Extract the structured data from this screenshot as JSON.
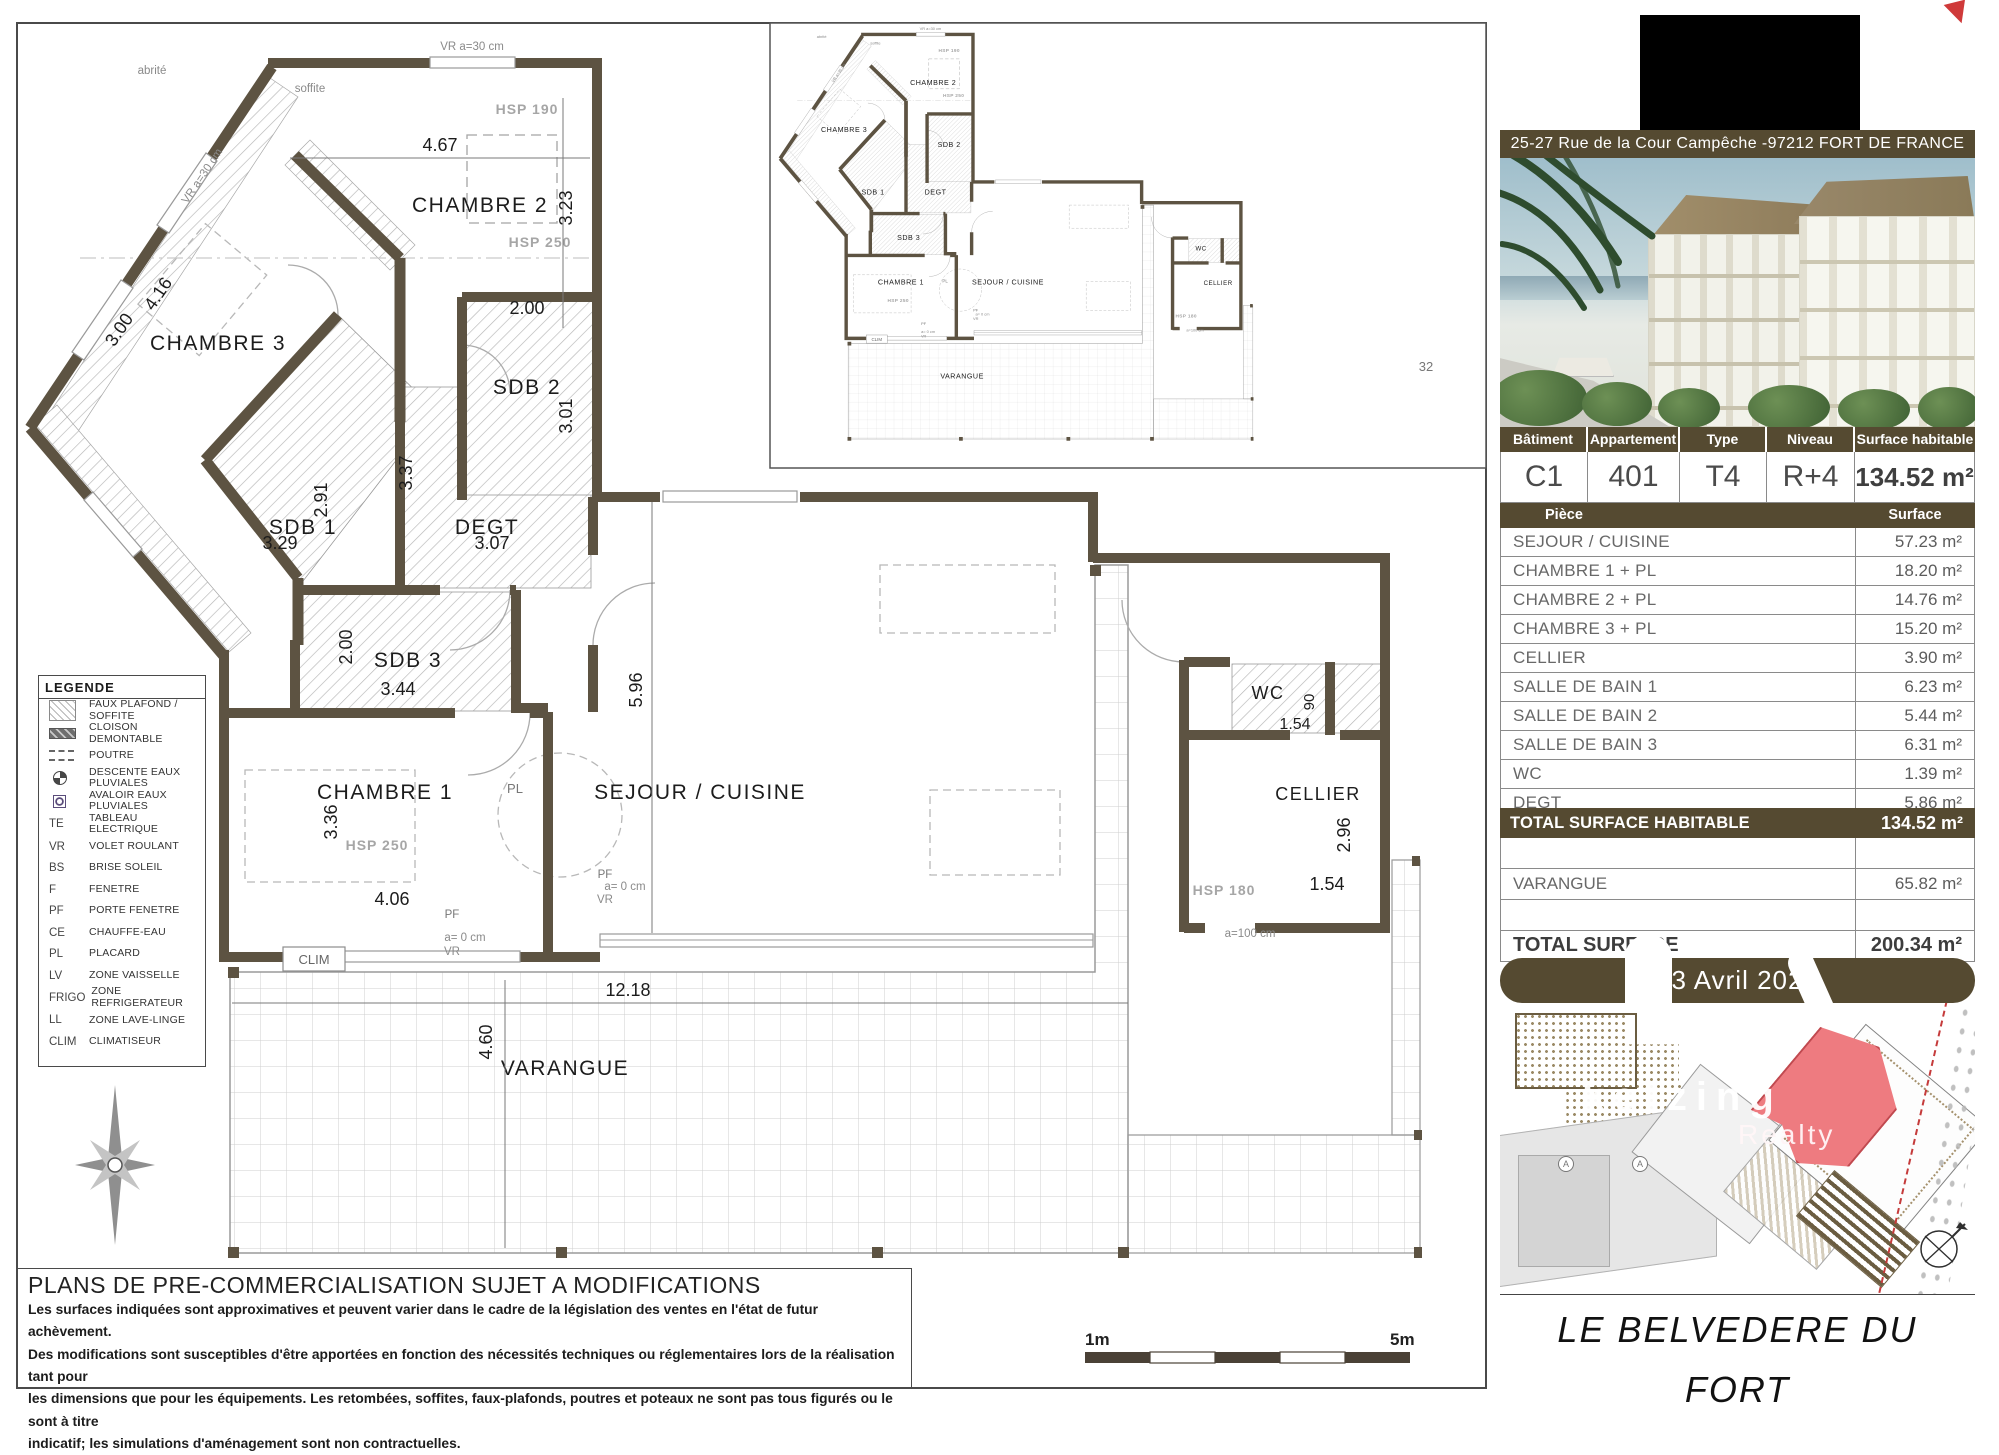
{
  "sheet": {
    "disclaimer_title": "PLANS DE PRE-COMMERCIALISATION SUJET A MODIFICATIONS",
    "disclaimer_lines": [
      "Les surfaces indiquées sont approximatives et peuvent varier dans le cadre de la législation des ventes en l'état de futur achèvement.",
      "Des modifications sont susceptibles d'être apportées en fonction des nécessités techniques ou réglementaires lors de la réalisation tant pour",
      "les dimensions que pour les équipements. Les retombées, soffites, faux-plafonds, poutres et poteaux ne sont pas tous figurés ou le sont à titre",
      "indicatif; les simulations d'aménagement sont non contractuelles."
    ],
    "scale_left": "1m",
    "scale_right": "5m",
    "grid_number": "32"
  },
  "legend": {
    "title": "LEGENDE",
    "items": [
      {
        "icon": "hatch",
        "label": "FAUX PLAFOND / SOFFITE"
      },
      {
        "icon": "cloison",
        "label": "CLOISON DEMONTABLE"
      },
      {
        "icon": "poutre",
        "label": "POUTRE"
      },
      {
        "icon": "dep",
        "label": "DESCENTE EAUX PLUVIALES"
      },
      {
        "icon": "aep",
        "label": "AVALOIR EAUX PLUVIALES"
      },
      {
        "abbr": "TE",
        "label": "TABLEAU ELECTRIQUE"
      },
      {
        "abbr": "VR",
        "label": "VOLET ROULANT"
      },
      {
        "abbr": "BS",
        "label": "BRISE SOLEIL"
      },
      {
        "abbr": "F",
        "label": "FENETRE"
      },
      {
        "abbr": "PF",
        "label": "PORTE FENETRE"
      },
      {
        "abbr": "CE",
        "label": "CHAUFFE-EAU"
      },
      {
        "abbr": "PL",
        "label": "PLACARD"
      },
      {
        "abbr": "LV",
        "label": "ZONE VAISSELLE"
      },
      {
        "abbr": "FRIGO",
        "label": "ZONE REFRIGERATEUR"
      },
      {
        "abbr": "LL",
        "label": "ZONE LAVE-LINGE"
      },
      {
        "abbr": "CLIM",
        "label": "CLIMATISEUR"
      }
    ]
  },
  "plan": {
    "rooms": {
      "chambre2": "CHAMBRE 2",
      "chambre3": "CHAMBRE 3",
      "sdb2": "SDB 2",
      "sdb1": "SDB 1",
      "degt": "DEGT",
      "sdb3": "SDB 3",
      "chambre1": "CHAMBRE 1",
      "sejour": "SEJOUR / CUISINE",
      "wc": "WC",
      "cellier": "CELLIER",
      "varangue": "VARANGUE"
    },
    "dims": {
      "d467": "4.67",
      "d323": "3.23",
      "d416": "4.16",
      "d300": "3.00",
      "d200a": "2.00",
      "d301": "3.01",
      "d291": "2.91",
      "d329": "3.29",
      "d337": "3.37",
      "d307": "3.07",
      "d200b": "2.00",
      "d344": "3.44",
      "d336": "3.36",
      "d406": "4.06",
      "d596": "5.96",
      "d90": "90",
      "d154a": "1.54",
      "d296": "2.96",
      "d154b": "1.54",
      "d1218": "12.18",
      "d460": "4.60"
    },
    "annot": {
      "hsp190": "HSP 190",
      "hsp250a": "HSP 250",
      "hsp250b": "HSP 250",
      "hsp180": "HSP 180",
      "soffite": "soffite",
      "abrite": "abrité",
      "vr30a": "VR a=30 cm",
      "vr30b": "VR a=30 cm",
      "pf1": "PF",
      "a01": "a= 0 cm",
      "vr1": "VR",
      "pf2": "PF",
      "a02": "a= 0 cm",
      "vr2": "VR",
      "a100": "a=100 cm",
      "clim": "CLIM",
      "pl": "PL"
    }
  },
  "sidebar": {
    "address": "25-27 Rue de la Cour Campêche -97212 FORT DE FRANCE",
    "info": {
      "headers": [
        "Bâtiment",
        "Appartement",
        "Type",
        "Niveau",
        "Surface habitable"
      ],
      "values": [
        "C1",
        "401",
        "T4",
        "R+4",
        "134.52 m²"
      ]
    },
    "table": {
      "col_piece": "Pièce",
      "col_surface": "Surface",
      "rows": [
        {
          "name": "SEJOUR / CUISINE",
          "value": "57.23 m²"
        },
        {
          "name": "CHAMBRE 1 + PL",
          "value": "18.20 m²"
        },
        {
          "name": "CHAMBRE 2 + PL",
          "value": "14.76 m²"
        },
        {
          "name": "CHAMBRE 3 + PL",
          "value": "15.20 m²"
        },
        {
          "name": "CELLIER",
          "value": "3.90 m²"
        },
        {
          "name": "SALLE DE BAIN 1",
          "value": "6.23 m²"
        },
        {
          "name": "SALLE DE BAIN 2",
          "value": "5.44 m²"
        },
        {
          "name": "SALLE DE BAIN 3",
          "value": "6.31 m²"
        },
        {
          "name": "WC",
          "value": "1.39 m²"
        },
        {
          "name": "DEGT",
          "value": "5.86 m²"
        }
      ]
    },
    "total_habitable": {
      "label": "TOTAL SURFACE HABITABLE",
      "value": "134.52 m²"
    },
    "varangue_row": {
      "label": "VARANGUE",
      "value": "65.82 m²"
    },
    "total_surface": {
      "label": "TOTAL SURFACE",
      "value": "200.34 m²"
    },
    "date": "23 Avril 2024",
    "project_title": "LE BELVEDERE DU FORT",
    "watermark": {
      "line1": "ketzing",
      "line2": "Realty"
    },
    "site_markers": [
      "A",
      "A"
    ],
    "colors": {
      "brown": "#554a31",
      "wall": "#5d5342",
      "highlight_unit": "#ee7b80",
      "accent_red": "#cf3a3a"
    }
  }
}
